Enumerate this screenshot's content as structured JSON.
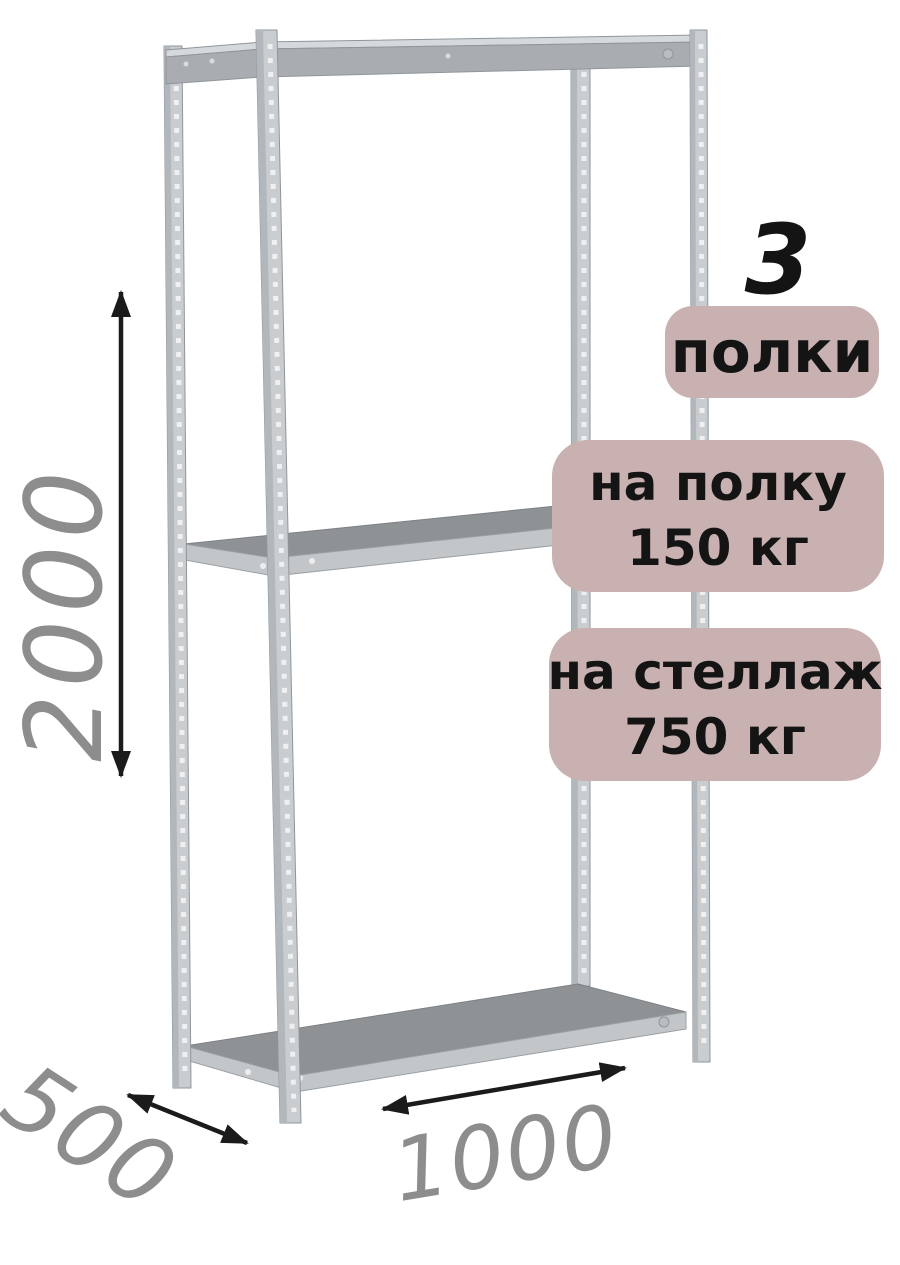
{
  "product_image": {
    "badges": {
      "count_number": "3",
      "count_label": "полки",
      "per_shelf": {
        "line1": "на полку",
        "line2": "150 кг"
      },
      "per_rack": {
        "line1": "на стеллаж",
        "line2": "750 кг"
      }
    },
    "dimensions": {
      "height": "2000",
      "depth": "500",
      "width": "1000"
    },
    "colors": {
      "badge_background": "#c8b1b0",
      "badge_text": "#141414",
      "dimension_text": "#8d8d8d",
      "arrow": "#1b1b1b",
      "metal_post_light": "#c9cdd0",
      "metal_post_flange": "#b2b7bb",
      "metal_beam": "#a9adb1",
      "shelf_top": "#8e9295",
      "shelf_face": "#c2c6c9",
      "background": "#ffffff"
    }
  }
}
